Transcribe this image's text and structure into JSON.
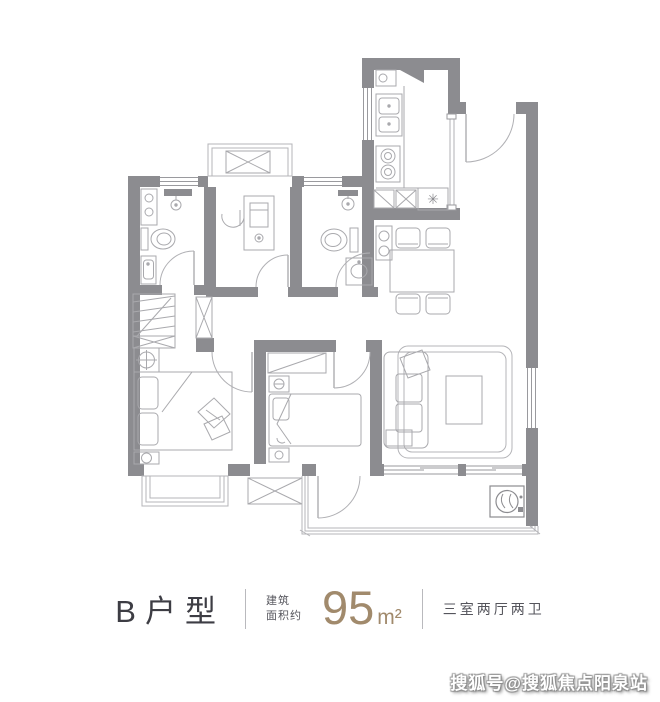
{
  "legend": {
    "unit_name": "B户型",
    "area_label_line1": "建筑",
    "area_label_line2": "面积约",
    "area_value": "95",
    "area_unit": "m²",
    "rooms_summary": "三室两厅两卫"
  },
  "watermark": {
    "text": "搜狐号@搜狐焦点阳泉站"
  },
  "symbols": {
    "drain": "✳"
  },
  "colors": {
    "wall": "#8c8c90",
    "furniture_line": "#a9a9ad",
    "thin_line": "#b4b4b8",
    "accent_gold": "#a18a6c",
    "legend_text": "#3d3d44",
    "secondary_text": "#55555c"
  }
}
